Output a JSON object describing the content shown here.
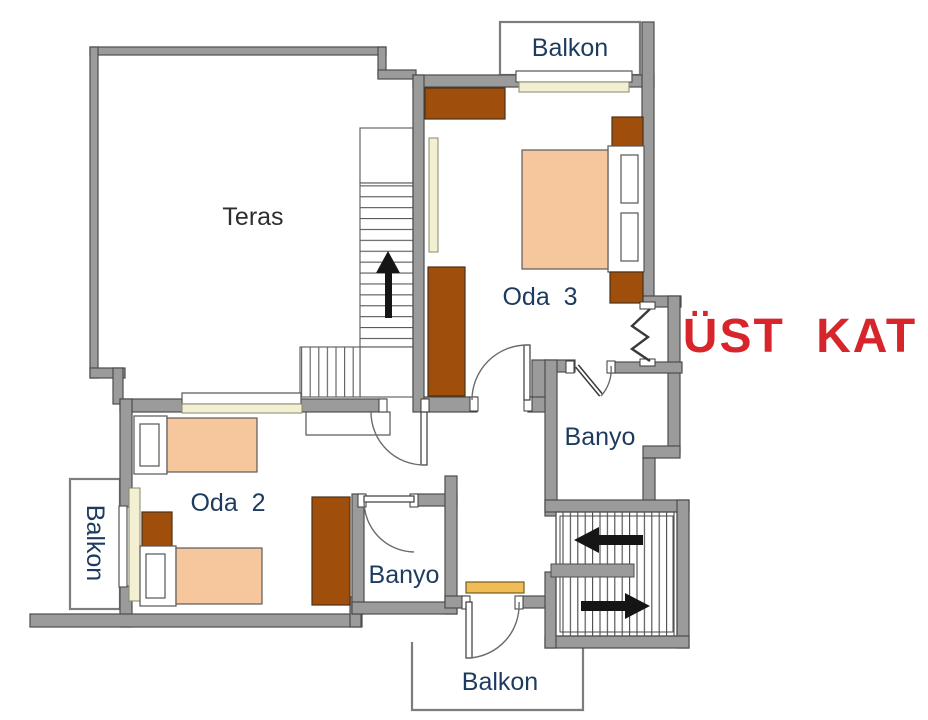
{
  "title": "ÜST KAT",
  "rooms": {
    "teras": "Teras",
    "oda3": "Oda  3",
    "oda2": "Oda  2",
    "banyo_upper": "Banyo",
    "banyo_lower": "Banyo"
  },
  "balconies": {
    "top": "Balkon",
    "left": "Balkon",
    "bottom": "Balkon"
  },
  "colors": {
    "wall": "#9b9b9b",
    "wall_stroke": "#4c4c4c",
    "furniture_brown": "#a04e0c",
    "bed_peach": "#f6c79c",
    "cream": "#f3efd3",
    "sill_yellow": "#eebd55",
    "label_navy": "#1d3b5f",
    "teras_gray": "#2e2e2e",
    "title_red": "#d6262b",
    "arrow_black": "#151515"
  }
}
